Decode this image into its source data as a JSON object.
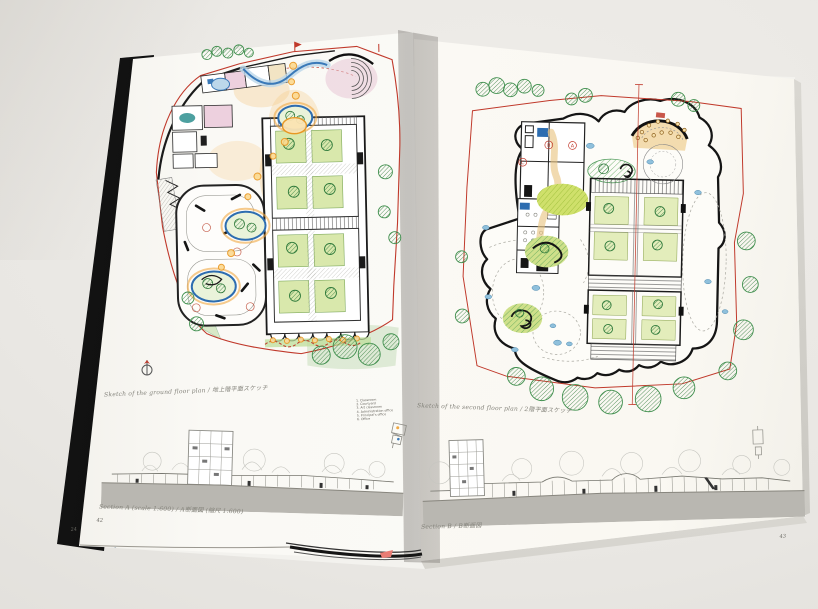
{
  "book": {
    "left_page": {
      "plan_caption": "Sketch of the ground floor plan / 地上階平面スケッチ",
      "legend": [
        "1. Classroom",
        "2. Courtyard",
        "3. Art classroom",
        "4. Administration office",
        "5. Principal's office",
        "6. Office"
      ],
      "section_caption": "Section A (scale 1:600) / A断面図 (縮尺 1:600)",
      "page_number": "42"
    },
    "right_page": {
      "plan_caption": "Sketch of the second floor plan / 2階平面スケッチ",
      "plan_labels": [
        "A",
        "B",
        "C"
      ],
      "section_caption": "Section B / B断面図",
      "page_number": "43"
    },
    "under_page_number": "24"
  },
  "colors": {
    "site_boundary_red": "#c0392b",
    "tree_green": "#3f8f4d",
    "lawn_green": "#cfe06b",
    "path_orange": "#f0a843",
    "water_blue": "#3a79b8",
    "ground_gray": "#b9b7b1",
    "desk_gray": "#e9e7e3"
  }
}
